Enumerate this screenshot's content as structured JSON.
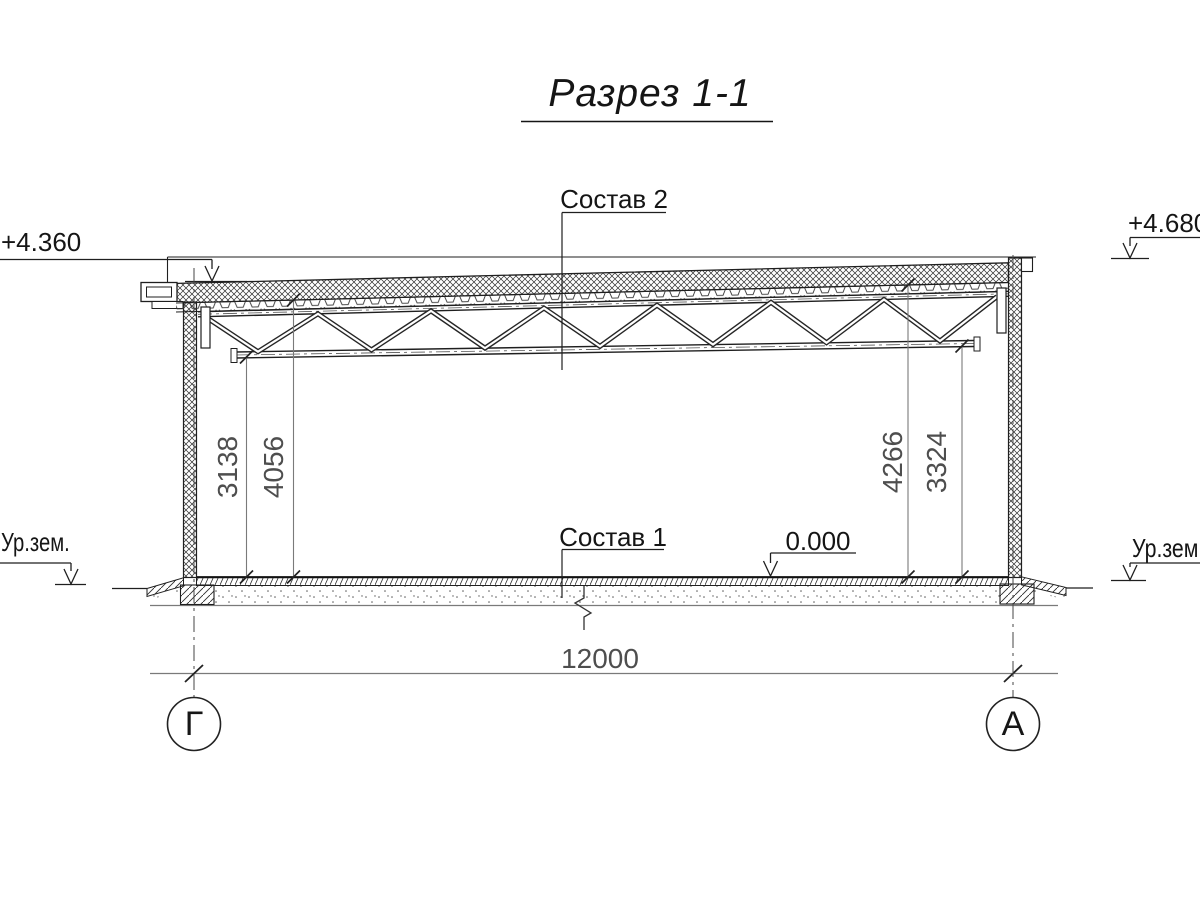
{
  "title": "Разрез 1-1",
  "marks": {
    "elev_left": "+4.360",
    "elev_right": "+4.680",
    "ground_left": "Ур.зем.",
    "ground_right": "Ур.зем.",
    "zero": "0.000",
    "roof_layers": "Состав 2",
    "floor_layers": "Состав 1"
  },
  "dims": {
    "span": "12000",
    "h_left_clear": "3138",
    "h_left_top": "4056",
    "h_right_top": "4266",
    "h_right_clear": "3324"
  },
  "axes": {
    "left": "Г",
    "right": "А"
  },
  "colors": {
    "line": "#1f1f1f",
    "dim_line": "#7a7a7a",
    "dim_text": "#4e4e4e",
    "bg": "#ffffff"
  }
}
